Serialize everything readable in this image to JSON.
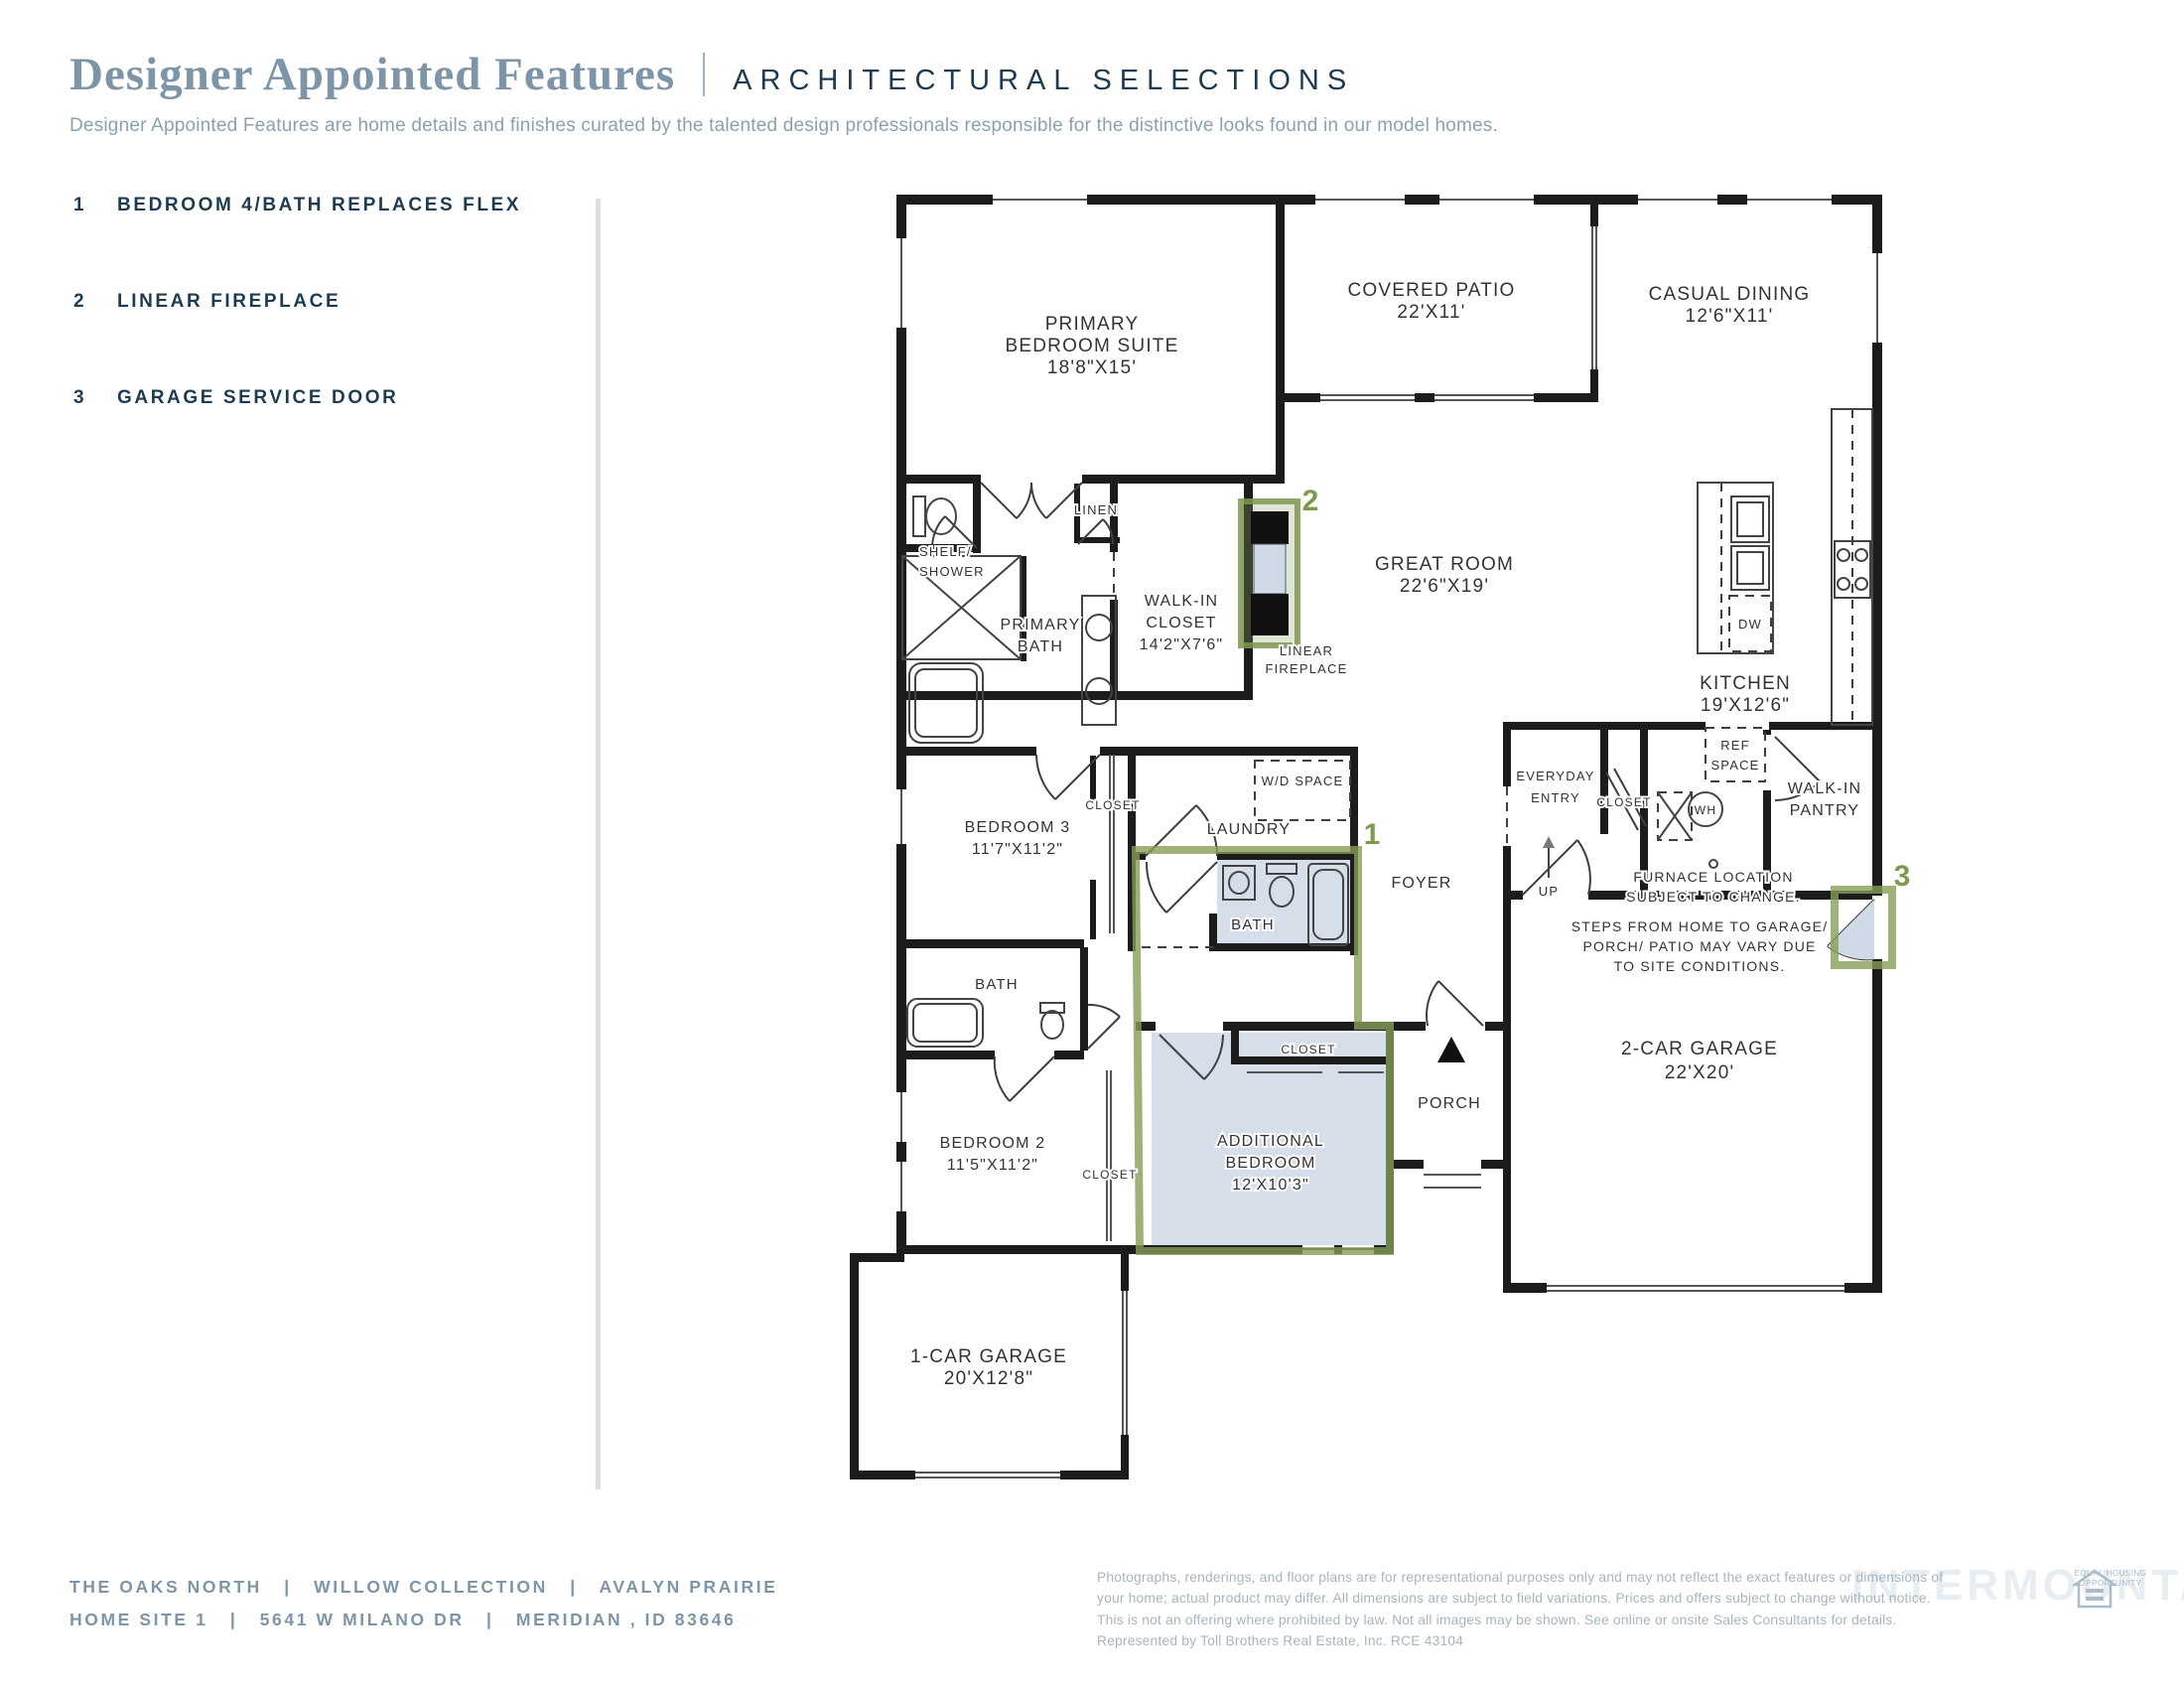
{
  "header": {
    "title": "Designer Appointed Features",
    "category": "ARCHITECTURAL SELECTIONS",
    "description": "Designer Appointed Features are home details and finishes curated by the talented design professionals responsible for the distinctive looks found in our model homes."
  },
  "features": [
    {
      "num": "1",
      "label": "BEDROOM 4/BATH REPLACES FLEX"
    },
    {
      "num": "2",
      "label": "LINEAR FIREPLACE"
    },
    {
      "num": "3",
      "label": "GARAGE SERVICE DOOR"
    }
  ],
  "floorplan": {
    "rooms": {
      "primary_bedroom": {
        "lines": [
          "PRIMARY",
          "BEDROOM SUITE",
          "18'8\"X15'"
        ]
      },
      "covered_patio": {
        "lines": [
          "COVERED PATIO",
          "22'X11'"
        ]
      },
      "casual_dining": {
        "lines": [
          "CASUAL DINING",
          "12'6\"X11'"
        ]
      },
      "great_room": {
        "lines": [
          "GREAT ROOM",
          "22'6\"X19'"
        ]
      },
      "kitchen": {
        "lines": [
          "KITCHEN",
          "19'X12'6\""
        ]
      },
      "walk_in_closet": {
        "lines": [
          "WALK-IN",
          "CLOSET",
          "14'2\"X7'6\""
        ]
      },
      "primary_bath": {
        "lines": [
          "PRIMARY",
          "BATH"
        ]
      },
      "linen": "LINEN",
      "shelf_shower": {
        "lines": [
          "SHELF/",
          "SHOWER"
        ]
      },
      "linear_fireplace": {
        "lines": [
          "LINEAR",
          "FIREPLACE"
        ]
      },
      "bedroom3": {
        "lines": [
          "BEDROOM 3",
          "11'7\"X11'2\""
        ]
      },
      "bedroom2": {
        "lines": [
          "BEDROOM 2",
          "11'5\"X11'2\""
        ]
      },
      "additional_bedroom": {
        "lines": [
          "ADDITIONAL",
          "BEDROOM",
          "12'X10'3\""
        ]
      },
      "laundry": "LAUNDRY",
      "foyer": "FOYER",
      "bath": "BATH",
      "porch": "PORCH",
      "closet": "CLOSET",
      "everyday_entry": {
        "lines": [
          "EVERYDAY",
          "ENTRY"
        ]
      },
      "walk_in_pantry": {
        "lines": [
          "WALK-IN",
          "PANTRY"
        ]
      },
      "garage2": {
        "lines": [
          "2-CAR GARAGE",
          "22'X20'"
        ]
      },
      "garage1": {
        "lines": [
          "1-CAR GARAGE",
          "20'X12'8\""
        ]
      }
    },
    "fixtures": {
      "dw": "DW",
      "wh": "WH",
      "ref_space": {
        "lines": [
          "REF",
          "SPACE"
        ]
      },
      "wd_space": "W/D SPACE",
      "up": "UP"
    },
    "notes": {
      "furnace": {
        "lines": [
          "FURNACE LOCATION",
          "SUBJECT TO CHANGE."
        ]
      },
      "steps": {
        "lines": [
          "STEPS FROM HOME TO GARAGE/",
          "PORCH/ PATIO MAY VARY DUE",
          "TO SITE CONDITIONS."
        ]
      }
    },
    "markers": {
      "bedroom4_bath": "1",
      "linear_fireplace": "2",
      "garage_service_door": "3"
    },
    "colors": {
      "highlight_green": "#85a050",
      "room_highlight_blue": "#d6dfe9",
      "wall": "#1c1c1c"
    }
  },
  "footer": {
    "line1": "THE OAKS NORTH   |   WILLOW COLLECTION   |   AVALYN PRAIRIE",
    "line2": "HOME SITE 1   |   5641 W MILANO DR   |   MERIDIAN , ID 83646",
    "disclaimer_lines": [
      "Photographs, renderings, and floor plans are for representational purposes only and may not reflect the exact features or dimensions of",
      "your home; actual product may differ. All dimensions are subject to field variations. Prices and offers subject to change without notice.",
      "This is not an offering where prohibited by law. Not all images may be shown. See online or onsite Sales Consultants for details.",
      "Represented by Toll Brothers Real Estate, Inc. RCE 43104"
    ],
    "equal_housing": {
      "line1": "EQUAL HOUSING",
      "line2": "OPPORTUNITY"
    },
    "watermark": "INTERMOUNTAIN"
  }
}
